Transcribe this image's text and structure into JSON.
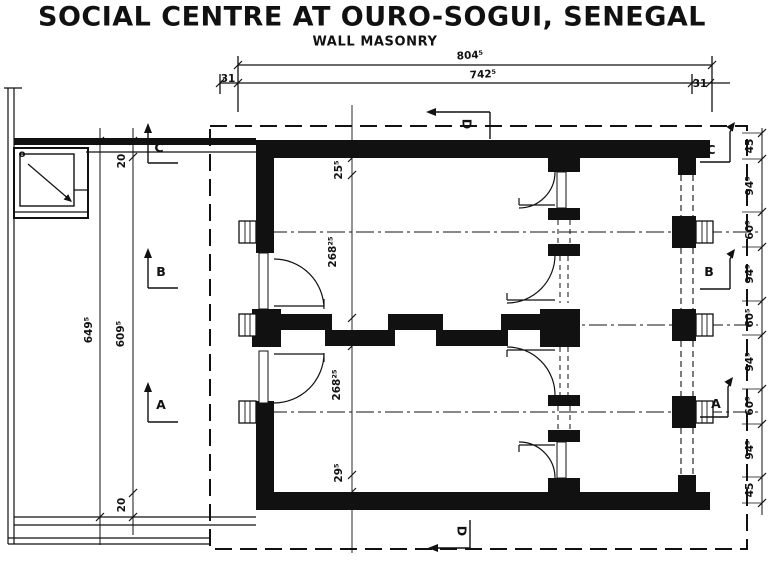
{
  "title": "SOCIAL CENTRE AT OURO-SOGUI, SENEGAL",
  "subtitle": "WALL MASONRY",
  "dimensions": {
    "top": {
      "overall": "804⁵",
      "clear": "742⁵",
      "left_wall": "31",
      "right_wall": "31"
    },
    "left": {
      "overall": "649⁵",
      "clear": "609⁵",
      "top_wall": "20",
      "bottom_wall": "20"
    },
    "interior": [
      "25⁵",
      "268²⁵",
      "268²⁵",
      "29⁵"
    ],
    "right_chain": [
      "45",
      "94⁵",
      "60⁵",
      "94⁵",
      "60⁵",
      "94⁵",
      "60⁵",
      "94⁵",
      "45"
    ]
  },
  "section_markers": {
    "left": [
      "C",
      "B",
      "A"
    ],
    "right": [
      "C",
      "B",
      "A"
    ],
    "top": "D",
    "bottom": "D"
  },
  "annotations": {
    "corner_marker": "o"
  },
  "colors": {
    "ink": "#111111",
    "paper": "#ffffff"
  }
}
